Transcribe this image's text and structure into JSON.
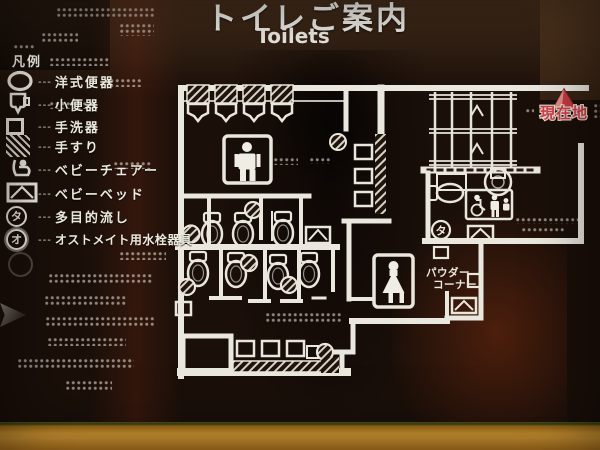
{
  "sign": {
    "title_ja": "トイレご案内",
    "title_en": "Toilets",
    "legend": {
      "heading": "凡例",
      "leader": "---",
      "items": [
        {
          "icon": "western-toilet-icon",
          "label": "洋式便器"
        },
        {
          "icon": "urinal-icon",
          "label": "小便器"
        },
        {
          "icon": "washbasin-icon",
          "label": "手洗器"
        },
        {
          "icon": "handrail-icon",
          "label": "手すり"
        },
        {
          "icon": "baby-chair-icon",
          "label": "ベビーチェアー"
        },
        {
          "icon": "baby-bed-icon",
          "label": "ベビーベッド"
        },
        {
          "icon": "multipurpose-sink-icon",
          "label": "多目的流し",
          "glyph": "タ"
        },
        {
          "icon": "ostomate-icon",
          "label": "オストメイト用水栓器具",
          "glyph": "オ"
        }
      ]
    },
    "map": {
      "current_location": "現在地",
      "powder_corner_line1": "パウダー",
      "powder_corner_line2": "コーナー",
      "multipurpose_glyph": "タ"
    },
    "colors": {
      "line": "#eae7df",
      "current_location_red": "#c43a42",
      "frame_orange": "#cb8f2c",
      "background": "#1a0f09"
    }
  }
}
